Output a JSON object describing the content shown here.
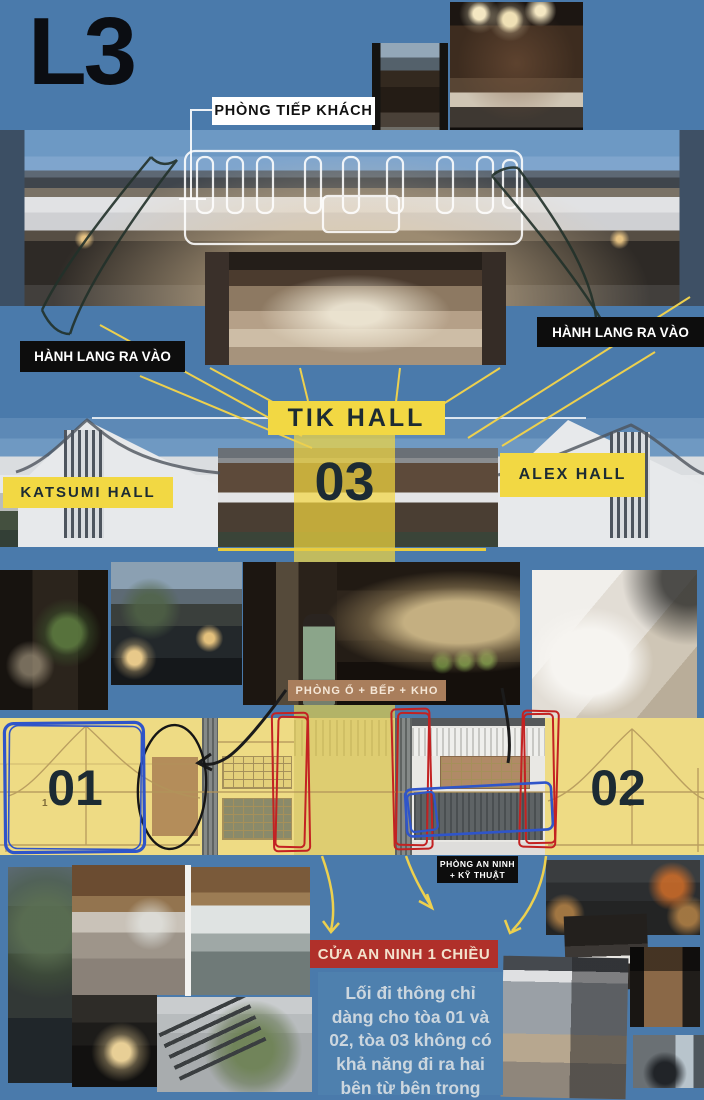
{
  "board": {
    "level_label": "L3"
  },
  "callouts": {
    "reception": "PHÒNG TIẾP KHÁCH",
    "corridor_left": "HÀNH LANG RA VÀO",
    "corridor_right": "HÀNH LANG RA VÀO",
    "tik_hall": "TIK HALL",
    "katsumi_hall": "KATSUMI HALL",
    "alex_hall": "ALEX HALL",
    "room_kitchen_storage": "PHÒNG Ổ + BẾP + KHO",
    "security_tech": "PHÒNG AN NINH + KỸ THUẬT",
    "one_way_security_door": "CỬA AN NINH 1 CHIỀU"
  },
  "towers": {
    "t01": "01",
    "t02": "02",
    "t03": "03"
  },
  "elevation": {
    "unit_marker": "1"
  },
  "note": {
    "text": "Lối đi thông chỉ dàng cho tòa 01 và 02, tòa 03 không có khả năng đi ra hai bên từ bên trong"
  },
  "colors": {
    "background": "#4a7aab",
    "accent_yellow": "#f2d843",
    "accent_red": "#b0302a",
    "label_brown": "#a97e5c",
    "label_black": "#0d0d0d",
    "note_panel": "#4e80ae",
    "note_text": "#ccd6de",
    "highlight_yellow": "#eedb84",
    "number_dark": "#1c2b33",
    "line_yellow": "#edd04e"
  },
  "photos": [
    "courtyard-entry",
    "moon-gate-living-room",
    "main-building-night",
    "lobby-interior",
    "twin-halls-panorama",
    "bonsai-dining-room",
    "water-courtyard",
    "kimono-reception",
    "white-sofa-lounge",
    "tree-wall-garden",
    "wood-ceiling-lounge",
    "indoor-pool",
    "lantern-water-court",
    "staircase-bonsai",
    "dark-kitchen-dining",
    "dark-bathroom",
    "wood-floor-corridor",
    "mirror-hallway",
    "bedroom-loft"
  ]
}
